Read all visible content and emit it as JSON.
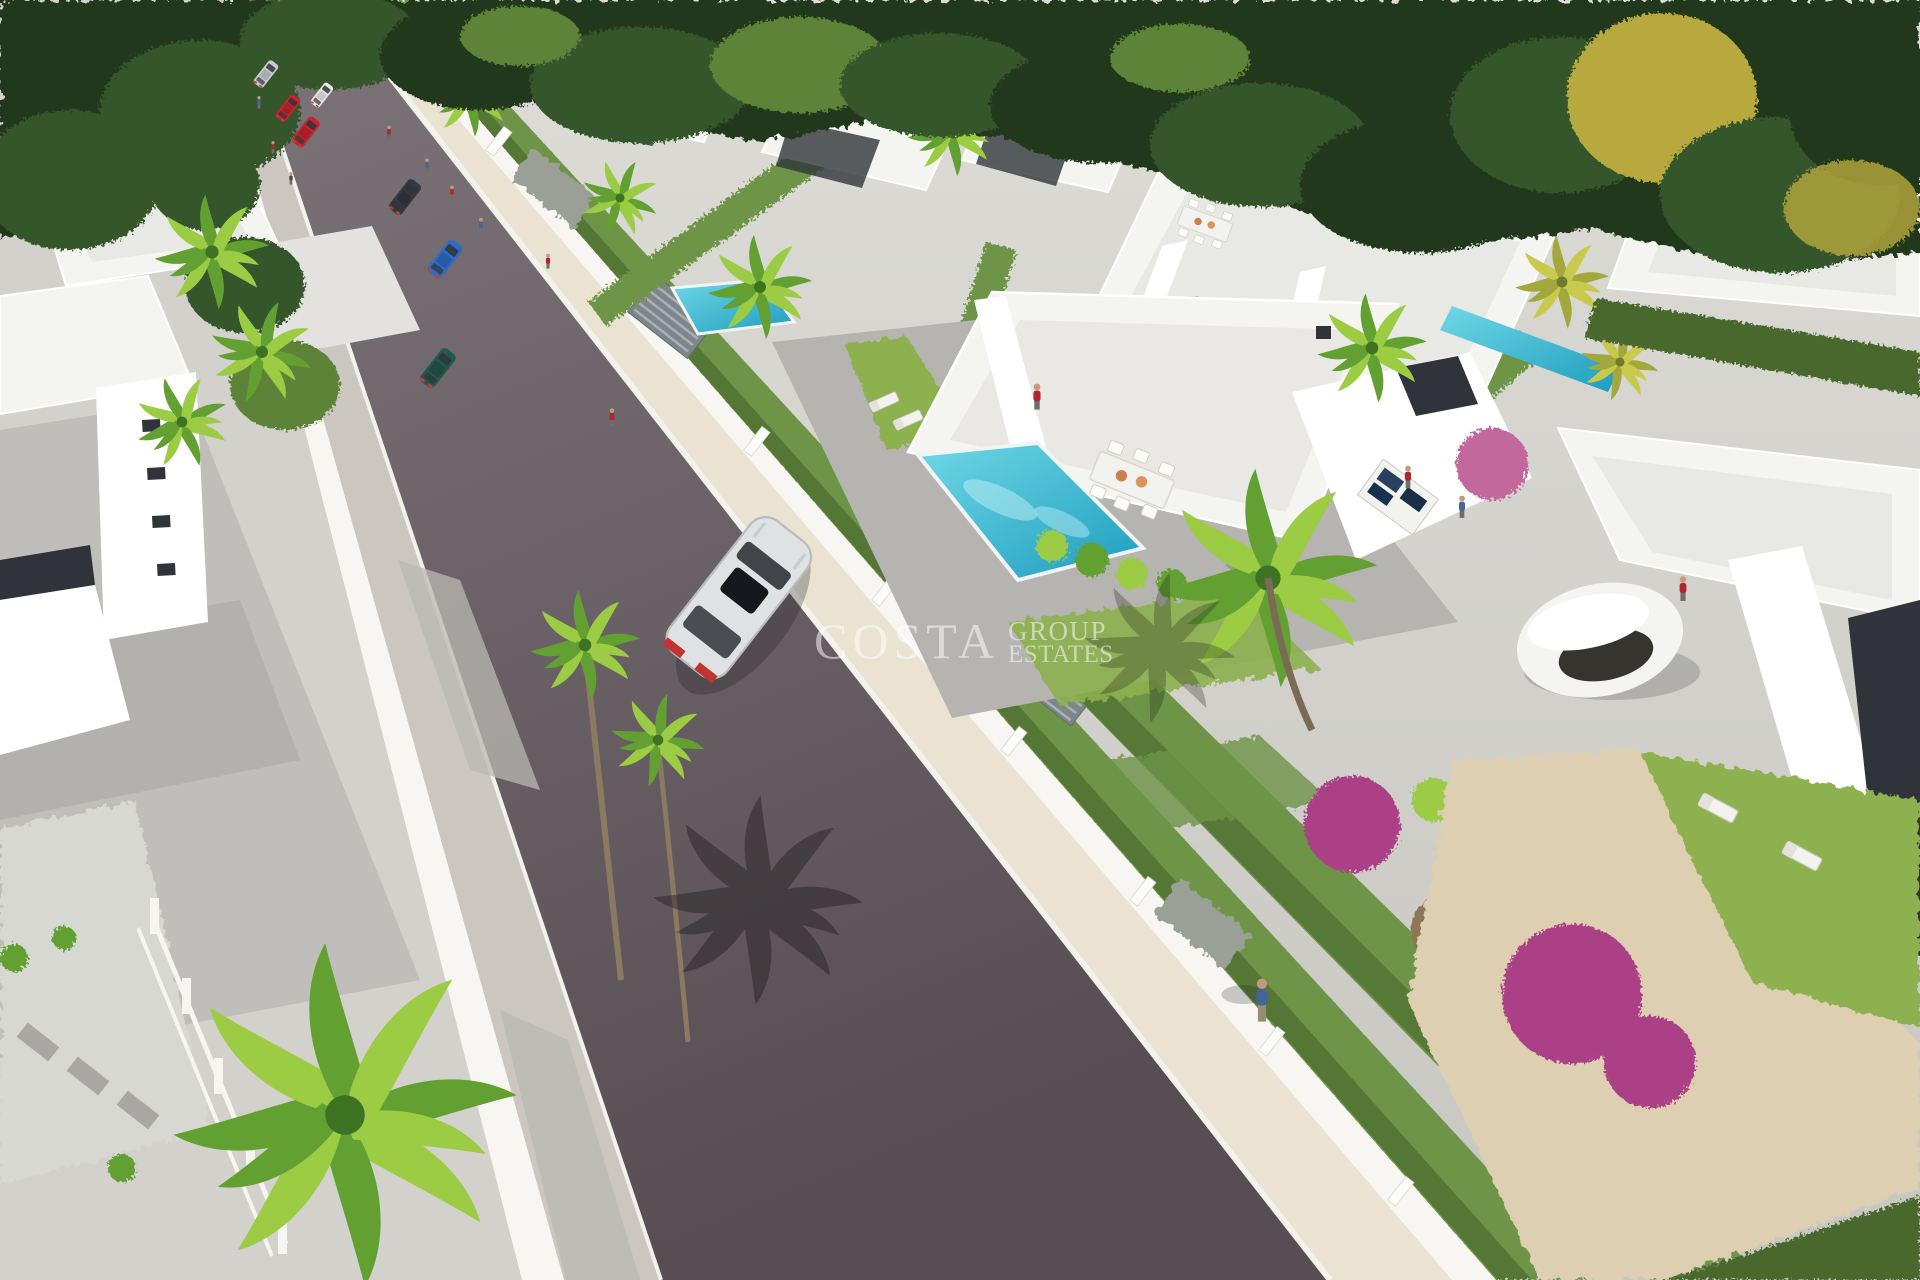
{
  "watermark": {
    "line1": "COSTA",
    "line2": "GROUP",
    "line3": "ESTATES"
  },
  "colors": {
    "canopy_dark": "#22381c",
    "canopy_mid": "#35552a",
    "canopy_light": "#5b8338",
    "canopy_yellow": "#b7a93c",
    "palm_light": "#9ccb44",
    "palm_mid": "#63a032",
    "palm_dark": "#3e7323",
    "hedge": "#6d9447",
    "hedge_dark": "#49682f",
    "lawn": "#8db14f",
    "road_top": "#7d7479",
    "road_mid": "#6b6267",
    "road_bottom": "#564e53",
    "curb": "#f2f1ec",
    "sidewalk_left": "#cbc7c0",
    "sidewalk_beige": "#eae3d1",
    "wall_white": "#f7f6f3",
    "pavement": "#d2d1cc",
    "pavement_dark": "#b9b8b3",
    "patio": "#b5b4b0",
    "roof_white": "#f4f4f1",
    "roof_shade": "#e3e2de",
    "building_white": "#ffffff",
    "glass_dark": "#30343a",
    "pool_light": "#6fd8e6",
    "pool_deep": "#1e9cbe",
    "gravel": "#decfb2",
    "dirt": "#8e7557",
    "flower_pink": "#c2679c",
    "flower_magenta": "#ab3f86",
    "gate_gray": "#7e858b",
    "gabion": "#9aa095",
    "car_red": "#c3242d",
    "car_blue": "#2e6cc4",
    "car_teal": "#23584c",
    "car_silver": "#c7cbce",
    "car_dark": "#34383f",
    "car_white": "#e9e9e7",
    "suv_body": "#dfe2e2",
    "person_red": "#b0262f",
    "person_blue": "#44659c",
    "person_dark": "#3f4a52",
    "person_khaki": "#9a8d6f",
    "skin": "#c49a7e",
    "table_white": "#f2f2ef",
    "panel_blue": "#28405e",
    "shadow": "#1c1c1c"
  }
}
